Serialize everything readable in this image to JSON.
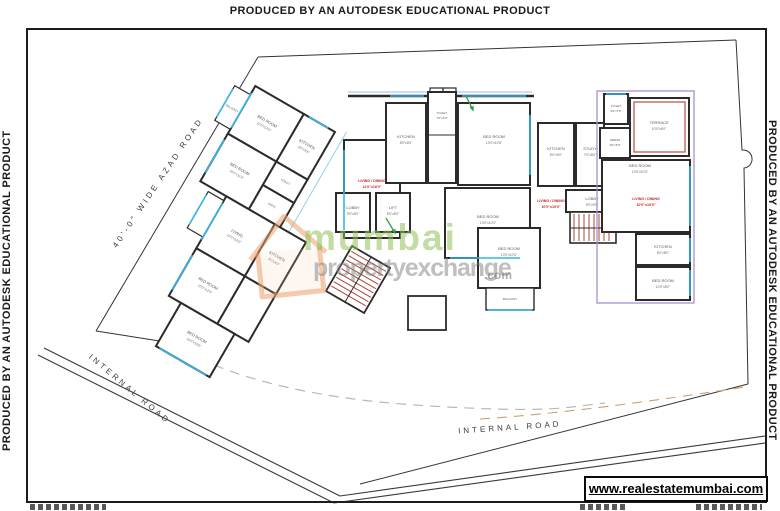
{
  "edge_banner": {
    "top": "PRODUCED BY AN AUTODESK EDUCATIONAL PRODUCT",
    "left": "PRODUCED BY AN AUTODESK EDUCATIONAL PRODUCT",
    "right": "PRODUCED BY AN AUTODESK EDUCATIONAL PRODUCT"
  },
  "roads": {
    "azad": "40'-0\" WIDE AZAD ROAD",
    "internal_left": "INTERNAL ROAD",
    "internal_bottom": "INTERNAL ROAD"
  },
  "watermark": {
    "word1": "mumbai",
    "word2": "propertyexchange",
    "word3": ".com"
  },
  "footer": {
    "website": "www.realestatemumbai.com"
  },
  "plan": {
    "rooms": [
      {
        "name": "BED ROOM",
        "dims": "10'0\"x12'0\""
      },
      {
        "name": "KITCHEN",
        "dims": "8'0\"x9'6\""
      },
      {
        "name": "BED ROOM",
        "dims": "10'0\"x11'6\""
      },
      {
        "name": "TOILET",
        "dims": "4'0\"x7'0\""
      },
      {
        "name": "BATH",
        "dims": "4'0\"x6'0\""
      },
      {
        "name": "LIVING",
        "dims": "10'0\"x15'0\""
      },
      {
        "name": "KITCHEN",
        "dims": "8'0\"x8'0\""
      },
      {
        "name": "BED ROOM",
        "dims": "10'0\"x12'0\""
      },
      {
        "name": "BED ROOM",
        "dims": "10'0\"x10'6\""
      },
      {
        "name": "BALCONY",
        "dims": ""
      },
      {
        "name": "KITCHEN",
        "dims": "8'0\"x8'0\""
      },
      {
        "name": "TOILET",
        "dims": "7'6\"x4'0\""
      },
      {
        "name": "BED ROOM",
        "dims": "10'0\"x10'6\""
      },
      {
        "name": "BED ROOM",
        "dims": "10'0\"x10'0\""
      },
      {
        "name": "LOBBY",
        "dims": "9'0\"x8'0\""
      },
      {
        "name": "LIFT",
        "dims": "8'0\"x8'0\""
      },
      {
        "name": "BED ROOM",
        "dims": "10'0\"x10'0\""
      },
      {
        "name": "LOBBY",
        "dims": "9'0\"x9'0\""
      },
      {
        "name": "KITCHEN",
        "dims": "8'0\"x9'0\""
      },
      {
        "name": "STUDY",
        "dims": "7'0\"x8'0\""
      },
      {
        "name": "TOILET",
        "dims": "4'0\"x7'6\""
      },
      {
        "name": "TERRACE",
        "dims": "10'0\"x8'0\""
      },
      {
        "name": "DRESS",
        "dims": "4'0\"x6'0\""
      },
      {
        "name": "BED ROOM",
        "dims": "10'0\"x10'0\""
      },
      {
        "name": "KITCHEN",
        "dims": "8'0\"x8'0\""
      },
      {
        "name": "BED ROOM",
        "dims": "10'0\"x8'0\""
      },
      {
        "name": "BALCONY",
        "dims": ""
      }
    ],
    "annotations": [
      {
        "line1": "LIVING / DINING",
        "line2": "11'0\"x18'0\""
      },
      {
        "line1": "LIVING / DINING",
        "line2": "10'0\"x19'0\""
      },
      {
        "line1": "LIVING / DINING",
        "line2": "10'0\"x19'0\""
      }
    ],
    "colors": {
      "wall": "#2b2b2b",
      "window_cyan": "#35b6e8",
      "unit_outline_purple": "#a98fd0",
      "terrace_outline_red": "#c2574b",
      "stair_red": "#a8473d",
      "annotation_red": "#cc1f1f",
      "watermark_green": "#8fbf57",
      "watermark_gray": "#808080",
      "logo_orange": "#eda06f"
    }
  }
}
